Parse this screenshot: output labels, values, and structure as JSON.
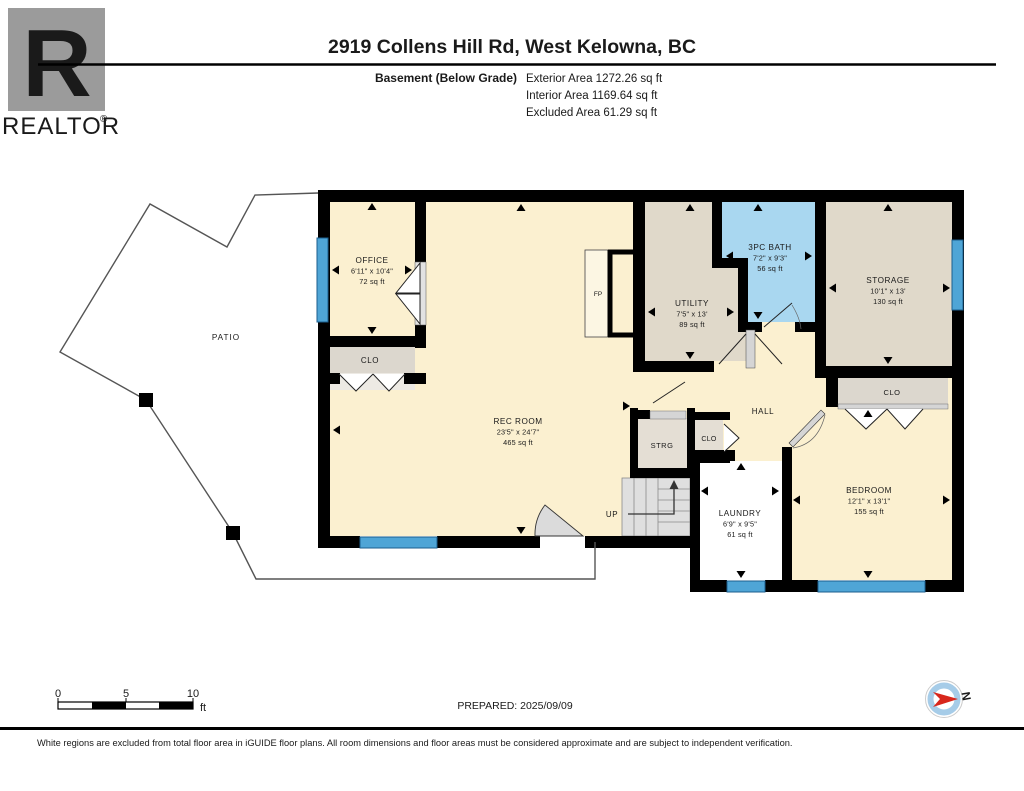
{
  "header": {
    "logo": {
      "letter": "R",
      "brand": "REALTOR",
      "registered": "®"
    },
    "title": "2919 Collens Hill Rd, West Kelowna, BC",
    "floor_label": "Basement (Below Grade)",
    "area_lines": [
      "Exterior Area 1272.26 sq ft",
      "Interior Area 1169.64 sq ft",
      "Excluded Area 61.29 sq ft"
    ]
  },
  "rooms": {
    "office": {
      "name": "OFFICE",
      "dims": "6'11\" x 10'4\"",
      "area": "72 sq ft"
    },
    "closet_office": {
      "name": "CLO"
    },
    "rec_room": {
      "name": "REC ROOM",
      "dims": "23'5\" x 24'7\"",
      "area": "465 sq ft"
    },
    "utility": {
      "name": "UTILITY",
      "dims": "7'5\" x 13'",
      "area": "89 sq ft"
    },
    "bath": {
      "name": "3PC BATH",
      "dims": "7'2\" x 9'3\"",
      "area": "56 sq ft"
    },
    "storage": {
      "name": "STORAGE",
      "dims": "10'1\" x 13'",
      "area": "130 sq ft"
    },
    "hall": {
      "name": "HALL"
    },
    "strg": {
      "name": "STRG"
    },
    "closet_hall": {
      "name": "CLO"
    },
    "closet_bedroom": {
      "name": "CLO"
    },
    "bedroom": {
      "name": "BEDROOM",
      "dims": "12'1\" x 13'1\"",
      "area": "155 sq ft"
    },
    "laundry": {
      "name": "LAUNDRY",
      "dims": "6'9\" x 9'5\"",
      "area": "61 sq ft"
    },
    "patio": {
      "name": "PATIO"
    },
    "stairs": {
      "label": "UP"
    },
    "fireplace": {
      "label": "FP"
    }
  },
  "scale_bar": {
    "ticks": [
      "0",
      "5",
      "10"
    ],
    "unit": "ft"
  },
  "prepared": "PREPARED: 2025/09/09",
  "compass": {
    "label": "N"
  },
  "footer": {
    "disclaimer": "White regions are excluded from total floor area in iGUIDE floor plans. All room dimensions and floor areas must be considered approximate and are subject to independent verification."
  },
  "colors": {
    "room_cream": "#FBF0D0",
    "room_tan": "#E0D9CA",
    "room_blue": "#A9D7F0",
    "closet_gray": "#DCD7CE",
    "window_blue": "#4FA5D6",
    "wall": "#000000",
    "compass_red": "#D8271C",
    "logo_gray": "#9B9B9B"
  }
}
